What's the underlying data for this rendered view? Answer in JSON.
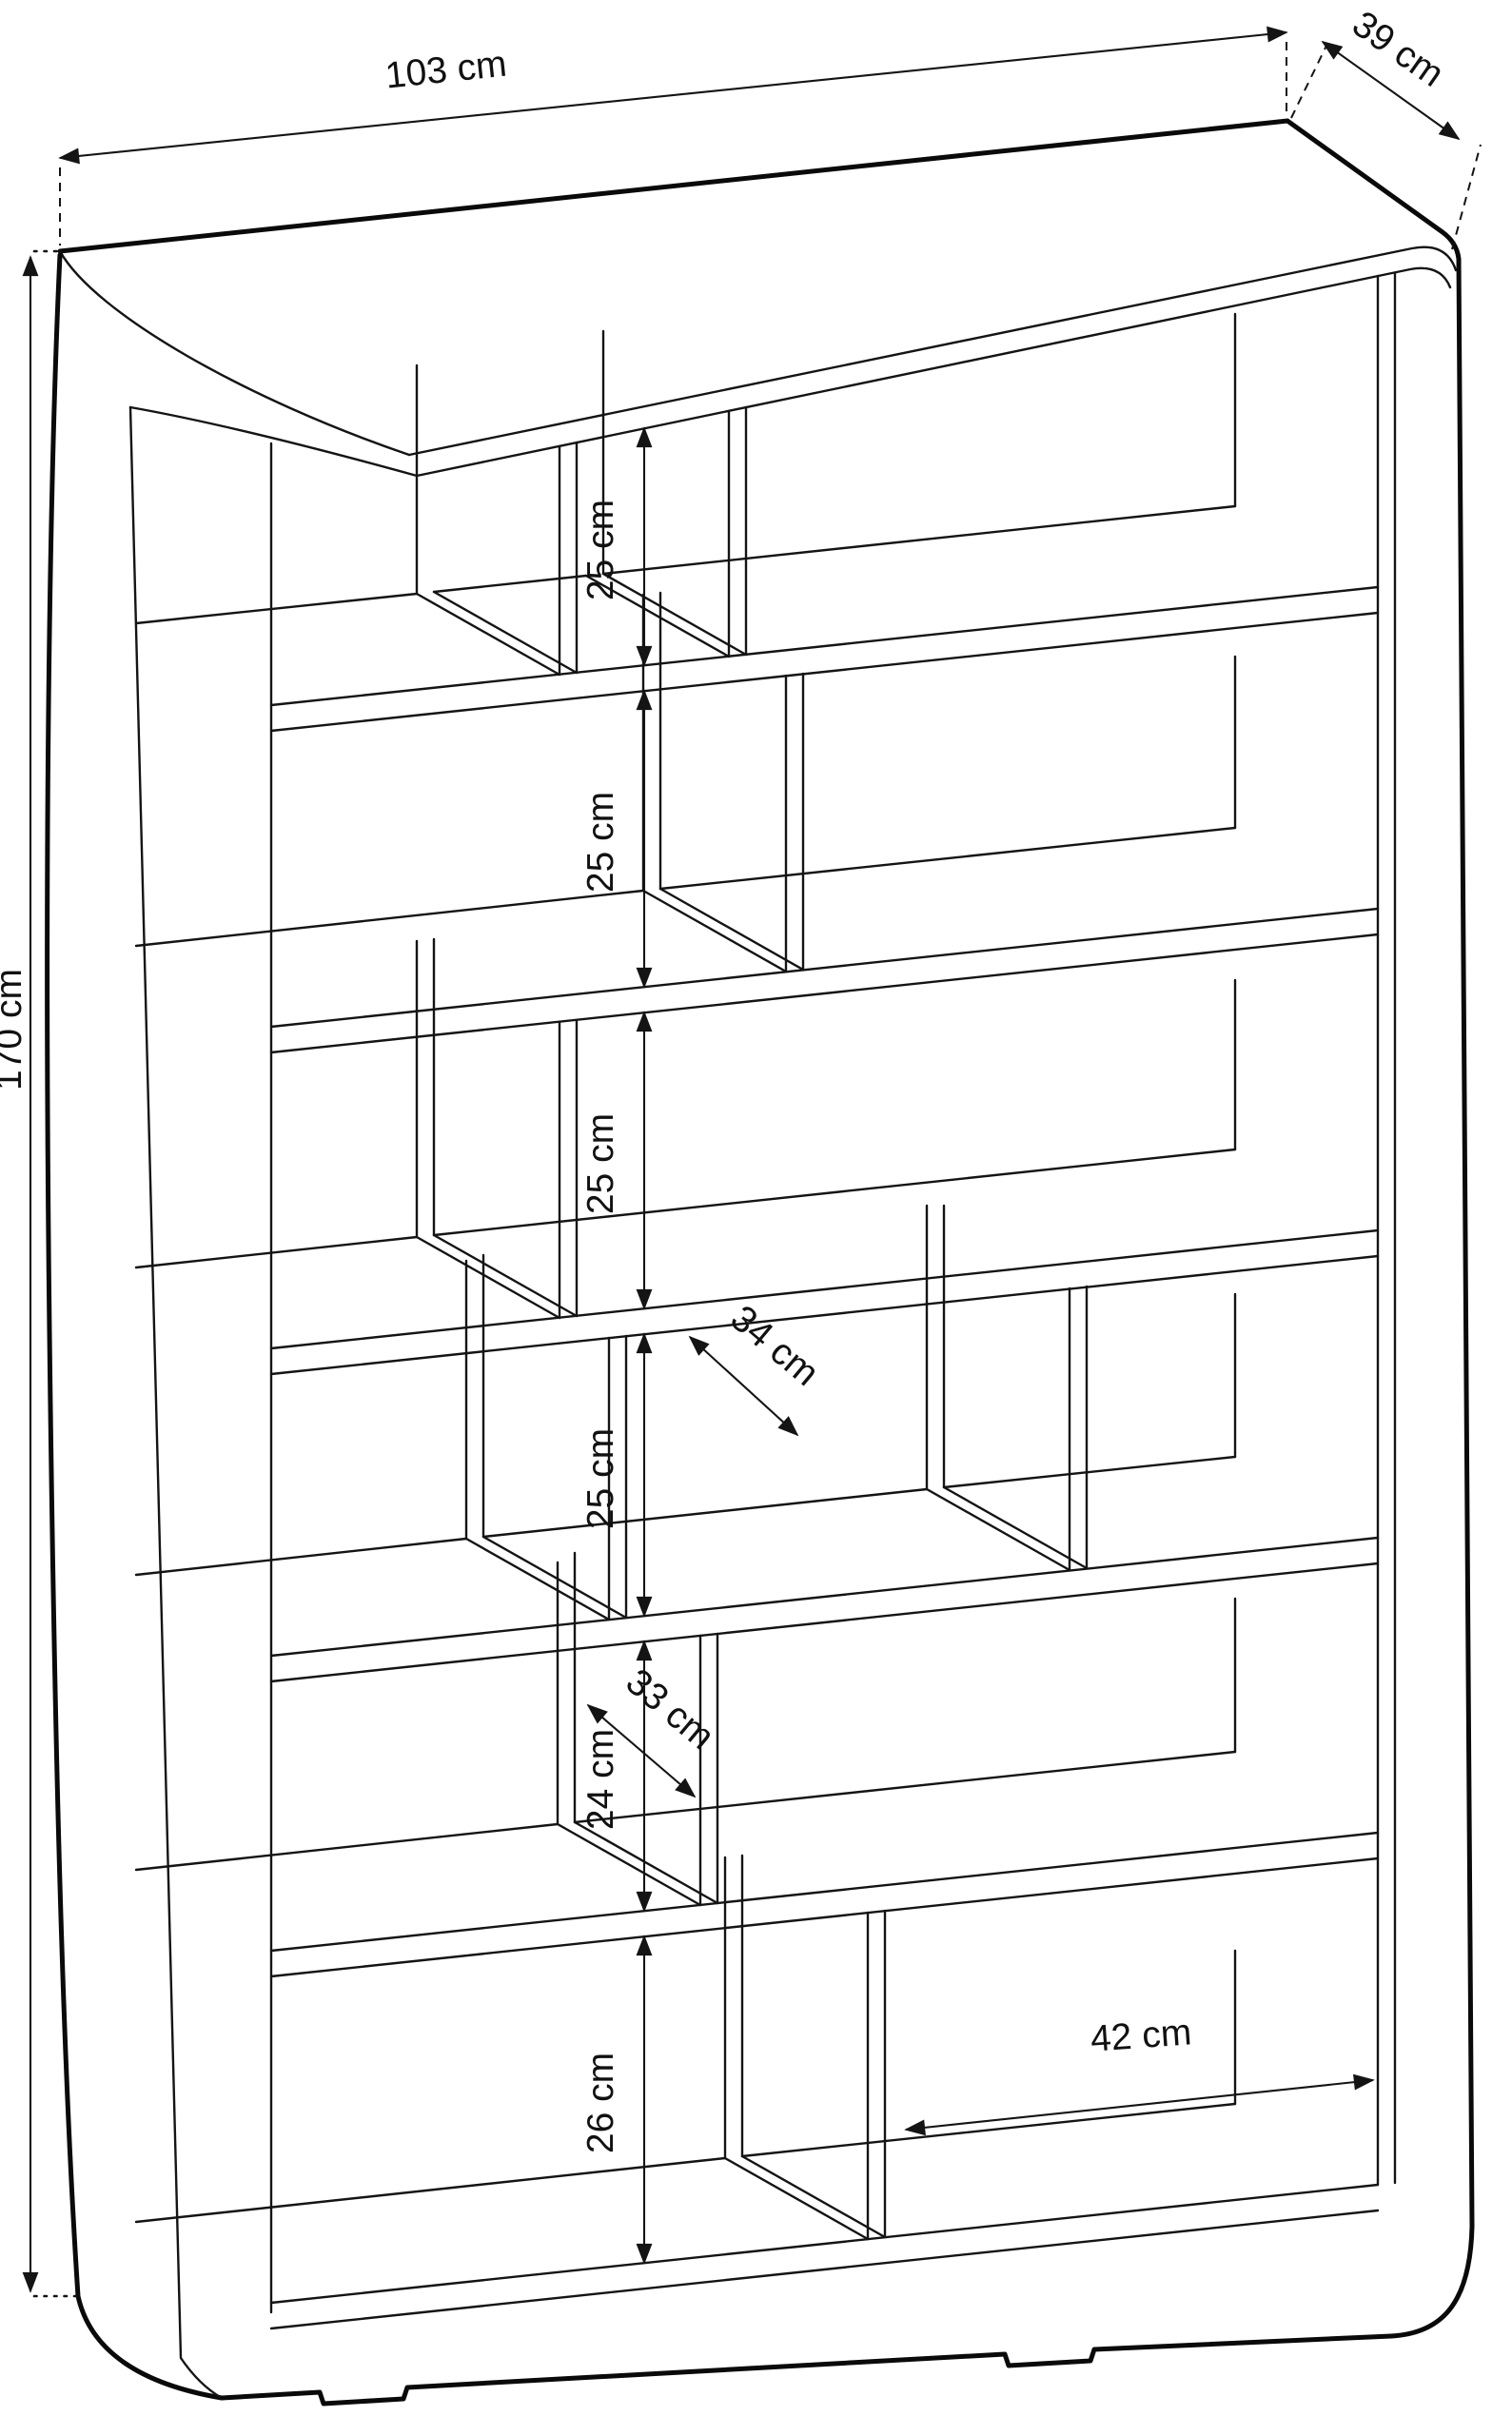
{
  "diagram": {
    "type": "furniture dimension drawing",
    "object": "bookshelf / shelving unit, perspective line drawing",
    "background_color": "#ffffff",
    "line_color": "#111111",
    "overall": {
      "width": "103 cm",
      "depth": "39 cm",
      "height": "170 cm"
    },
    "row_heights": [
      "25 cm",
      "25 cm",
      "25 cm",
      "25 cm",
      "24 cm",
      "26 cm"
    ],
    "compartment_widths": {
      "row4": "34 cm",
      "row5": "33 cm",
      "row6": "42 cm"
    }
  }
}
